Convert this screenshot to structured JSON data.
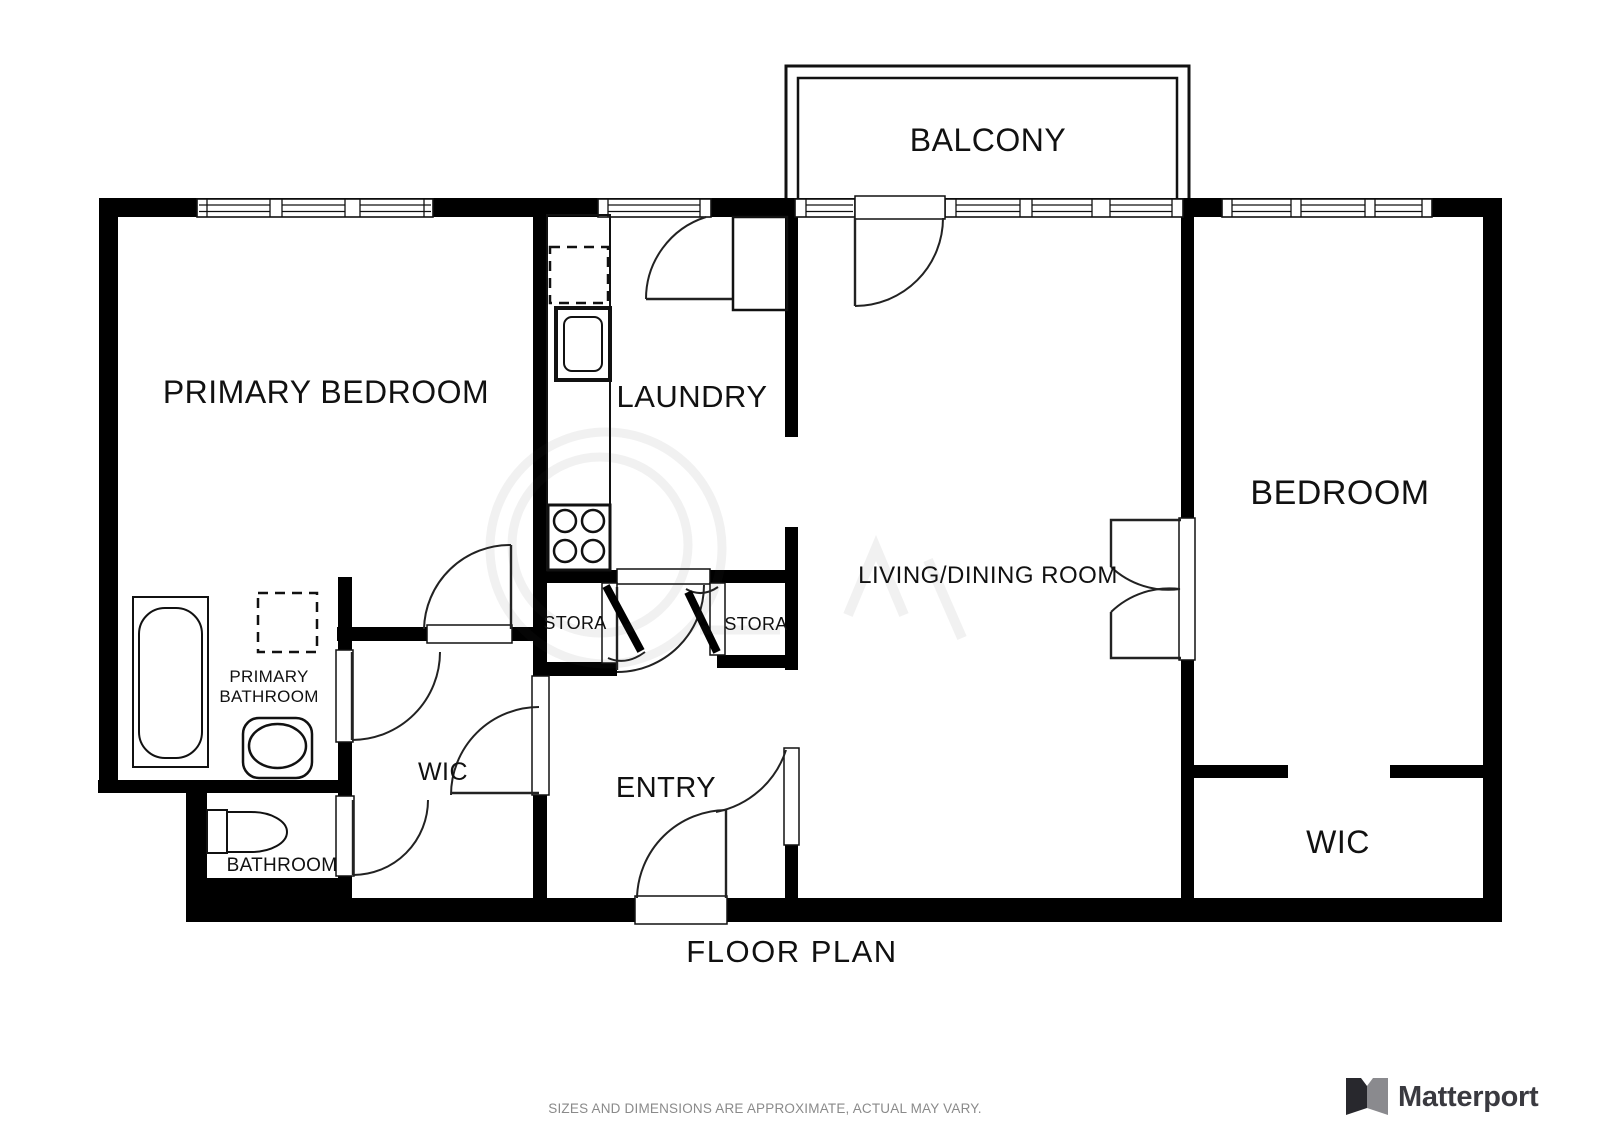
{
  "captions": {
    "floor_plan_title": "FLOOR PLAN",
    "disclaimer": "SIZES AND DIMENSIONS ARE APPROXIMATE, ACTUAL MAY VARY."
  },
  "branding": {
    "wordmark": "Matterport",
    "logo_icon": "matterport-m-icon",
    "wordmark_color": "#3a3a40",
    "icon_dark_color": "#28282d",
    "icon_gray_color": "#8a8a8e"
  },
  "colors": {
    "background": "#ffffff",
    "walls": "#000000",
    "labels": "#111111",
    "disclaimer_text": "#8a8a8a"
  },
  "rooms": [
    {
      "id": "balcony",
      "label": "BALCONY"
    },
    {
      "id": "primary-bedroom",
      "label": "PRIMARY BEDROOM"
    },
    {
      "id": "laundry",
      "label": "LAUNDRY"
    },
    {
      "id": "living-dining",
      "label": "LIVING/DINING ROOM"
    },
    {
      "id": "bedroom",
      "label": "BEDROOM"
    },
    {
      "id": "primary-bathroom",
      "label": "PRIMARY BATHROOM",
      "line1": "PRIMARY",
      "line2": "BATHROOM"
    },
    {
      "id": "storage-left",
      "label": "STORA"
    },
    {
      "id": "storage-right",
      "label": "STORA"
    },
    {
      "id": "wic-left",
      "label": "WIC"
    },
    {
      "id": "entry",
      "label": "ENTRY"
    },
    {
      "id": "bathroom",
      "label": "BATHROOM"
    },
    {
      "id": "wic-right",
      "label": "WIC"
    }
  ]
}
